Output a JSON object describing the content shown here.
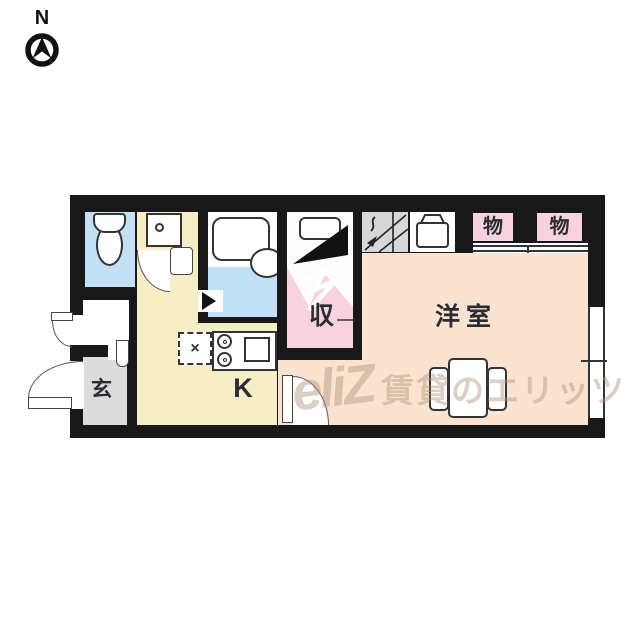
{
  "compass": {
    "label": "N"
  },
  "labels": {
    "entrance": "玄",
    "kitchen": "K",
    "closet": "収",
    "western_room": "洋室",
    "storage_1": "物",
    "storage_2": "物",
    "refrigerator_mark": "×"
  },
  "watermark": {
    "logo": "eliZ",
    "text": "賃貸のエリッツ"
  },
  "colors": {
    "wall": "#181818",
    "water_rooms_blue": "#c3e1f5",
    "kitchen_hall_cream": "#f6eec7",
    "closet_pink": "#f6d3de",
    "western_room_peach": "#fbe3d2",
    "entrance_gray": "#dcdcdc",
    "hatch_gray": "#d8d8d8"
  },
  "icons": [
    "north-compass-icon",
    "toilet-icon",
    "washbasin-icon",
    "bathtub-icon",
    "bath-basin-icon",
    "folding-door-icon",
    "stairs-icon",
    "washing-machine-icon",
    "stove-burners-icon",
    "sink-icon",
    "refrigerator-slot-icon",
    "table-icon",
    "chair-icon",
    "door-swing-arc"
  ]
}
